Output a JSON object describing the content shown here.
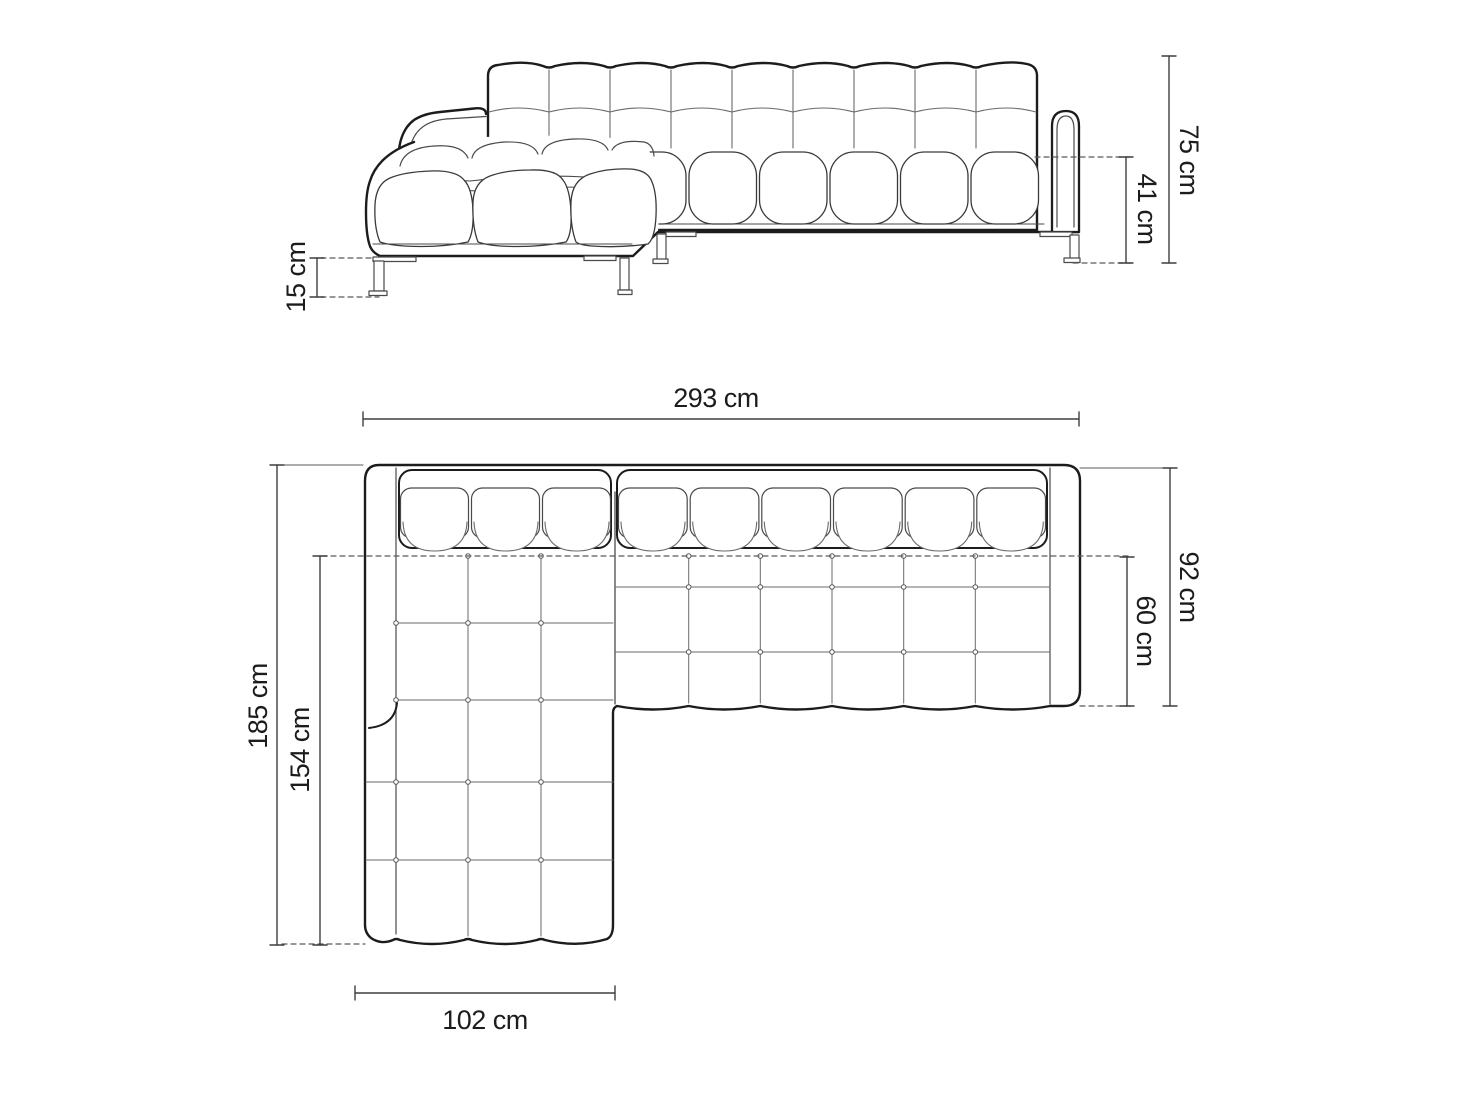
{
  "drawing": {
    "unit": "cm",
    "colors": {
      "background": "#ffffff",
      "outline_ink": "#1c1c1c",
      "seam_line": "#4a4a4a",
      "light_line": "#8a8a8a",
      "dimension_line": "#3f3f3f",
      "dashed_line": "#5a5a5a",
      "text": "#1c1c1c"
    }
  },
  "dims": {
    "total_height": {
      "label": "75 cm",
      "value": 75
    },
    "seat_height": {
      "label": "41 cm",
      "value": 41
    },
    "leg_height": {
      "label": "15 cm",
      "value": 15
    },
    "total_width": {
      "label": "293 cm",
      "value": 293
    },
    "total_depth": {
      "label": "185 cm",
      "value": 185
    },
    "chaise_depth": {
      "label": "154 cm",
      "value": 154
    },
    "body_depth": {
      "label": "92 cm",
      "value": 92
    },
    "seat_depth": {
      "label": "60 cm",
      "value": 60
    },
    "chaise_width": {
      "label": "102 cm",
      "value": 102
    }
  }
}
